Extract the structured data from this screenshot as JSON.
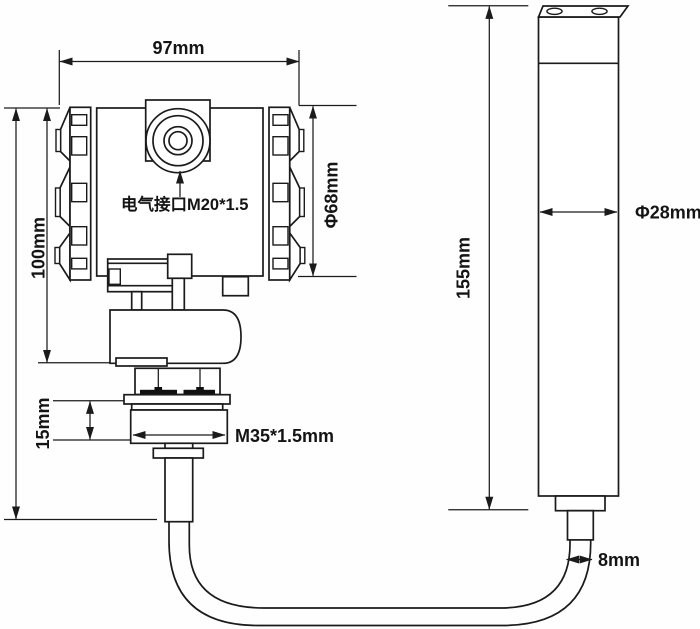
{
  "diagram": {
    "type": "technical-dimensional-drawing",
    "subject": "Submersible level transmitter: electronics housing with threaded fitting, cable and cylindrical sensor probe",
    "colors": {
      "background": "#fefefe",
      "line": "#1b1b1b",
      "text": "#141414"
    },
    "transmitter": {
      "width_label": "97mm",
      "height_label": "100mm",
      "housing_diameter_label": "Φ68mm",
      "electrical_port_label": "电气接口M20*1.5",
      "thread_height_label": "15mm",
      "thread_spec_label": "M35*1.5mm"
    },
    "probe": {
      "length_label": "155mm",
      "diameter_label": "Φ28mm",
      "cable_diameter_label": "8mm"
    }
  }
}
